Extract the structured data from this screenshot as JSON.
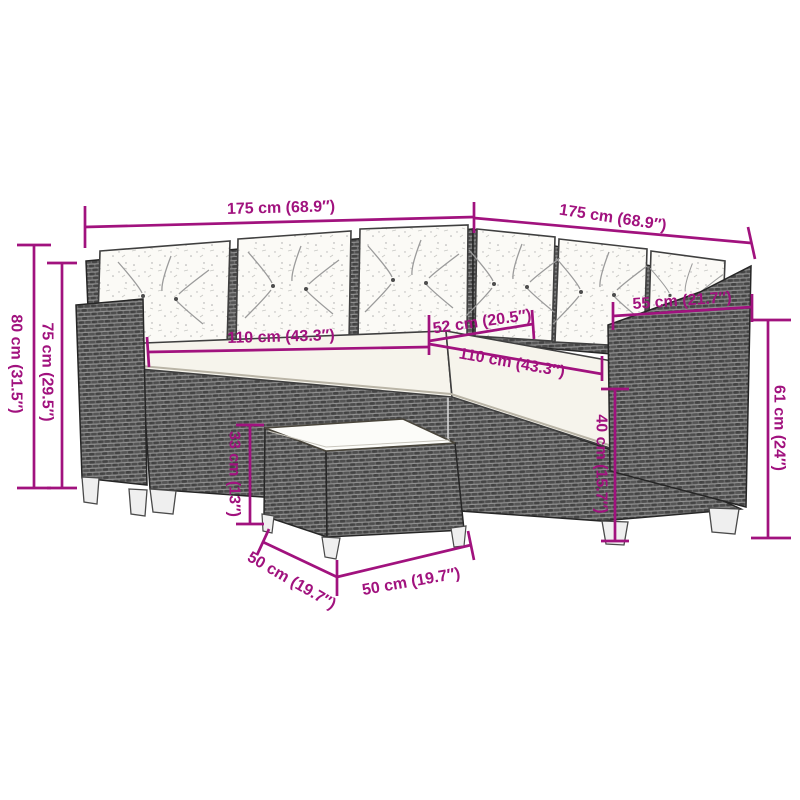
{
  "figure": {
    "description": "Dimension diagram of an L-shaped poly rattan garden sofa with back cushions, seat cushions and a square coffee table"
  },
  "colors": {
    "dimension": "#A1127E",
    "background": "#ffffff",
    "rattan": "#6b6b6b",
    "cushion": "#fbfaf6"
  },
  "dimensions": {
    "back_width_left": "175 cm (68.9″)",
    "back_width_right": "175 cm (68.9″)",
    "total_height": "80 cm (31.5″)",
    "backrest_height": "75 cm (29.5″)",
    "seat_width_left": "110 cm (43.3″)",
    "corner_seat_width": "52 cm (20.5″)",
    "seat_width_right": "110 cm (43.3″)",
    "armrest_section_width": "55 cm (21.7″)",
    "armrest_height": "61 cm (24″)",
    "seat_height": "40 cm (15.7″)",
    "table_height": "33 cm (13″)",
    "table_depth": "50 cm (19.7″)",
    "table_width": "50 cm (19.7″)"
  }
}
